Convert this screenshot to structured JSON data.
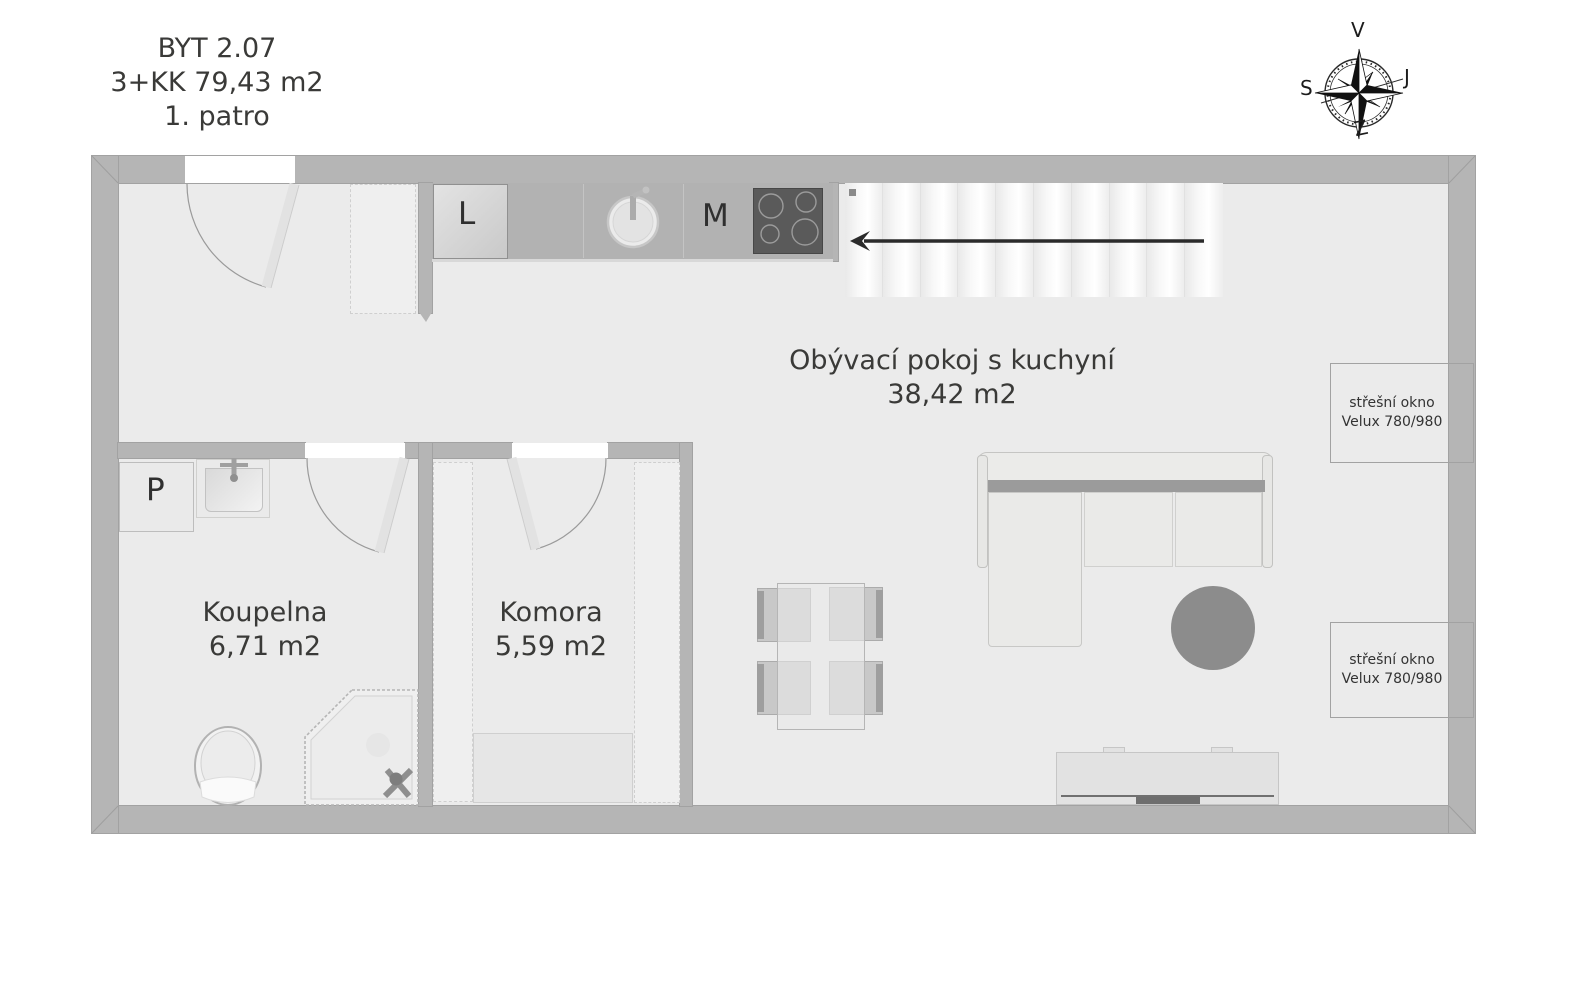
{
  "title": {
    "line1": "BYT 2.07",
    "line2": "3+KK 79,43 m2",
    "line3": "1. patro"
  },
  "compass": {
    "top": "V",
    "right": "J",
    "bottom": "Z",
    "left": "S"
  },
  "rooms": {
    "living": {
      "name": "Obývací pokoj s kuchyní",
      "area": "38,42 m2"
    },
    "bathroom": {
      "name": "Koupelna",
      "area": "6,71 m2"
    },
    "storage": {
      "name": "Komora",
      "area": "5,59 m2"
    }
  },
  "kitchen": {
    "fridge_label": "L",
    "appliance_label": "M"
  },
  "bathroom_items": {
    "washer_label": "P"
  },
  "roof_windows": [
    {
      "line1": "střešní okno",
      "line2": "Velux 780/980"
    },
    {
      "line1": "střešní okno",
      "line2": "Velux 780/980"
    }
  ],
  "colors": {
    "wall": "#b5b5b5",
    "line": "#a2a2a2",
    "floor": "#ebebeb",
    "counter": "#b2b2b2",
    "cooktop": "#5a5a5a",
    "rug": "#8c8c8c",
    "text": "#3a3a38",
    "arrow": "#2b2b2b"
  }
}
